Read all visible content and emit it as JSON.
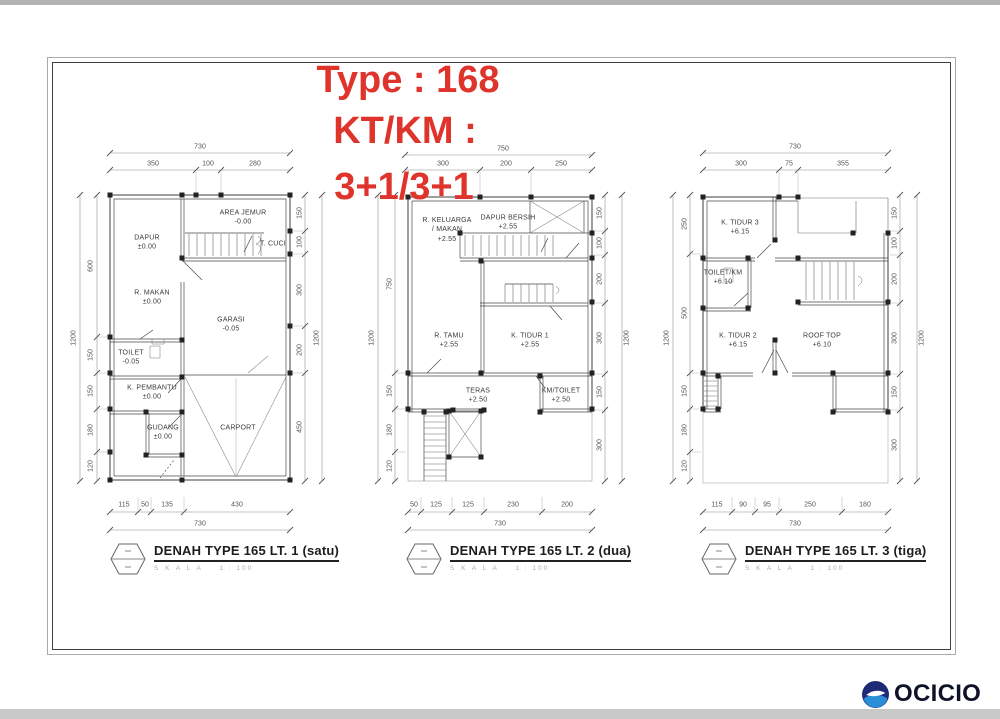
{
  "page": {
    "title_lines": [
      "Type : 168",
      "KT/KM :",
      "3+1/3+1"
    ],
    "accent_red": "#de342b",
    "logo_text": "OCICIO",
    "logo_navy": "#1d2b77",
    "logo_blue": "#2b8fd8"
  },
  "plans": [
    {
      "caption": "DENAH TYPE 165 LT. 1 (satu)",
      "scale_label": "S K A L A",
      "scale_value": "1 : 100",
      "rooms": [
        {
          "text": "AREA JEMUR\n-0.00",
          "x": 243,
          "y": 218
        },
        {
          "text": "DAPUR\n±0.00",
          "x": 147,
          "y": 243
        },
        {
          "text": "T. CUCI",
          "x": 273,
          "y": 244
        },
        {
          "text": "R. MAKAN\n±0.00",
          "x": 152,
          "y": 298
        },
        {
          "text": "GARASI\n-0.05",
          "x": 231,
          "y": 325
        },
        {
          "text": "TOILET\n-0.05",
          "x": 131,
          "y": 358
        },
        {
          "text": "K. PEMBANTU\n±0.00",
          "x": 152,
          "y": 393
        },
        {
          "text": "GUDANG\n±0.00",
          "x": 163,
          "y": 433
        },
        {
          "text": "CARPORT",
          "x": 238,
          "y": 428
        }
      ],
      "dims": [
        {
          "text": "730",
          "x": 200,
          "y": 147
        },
        {
          "text": "350",
          "x": 153,
          "y": 164
        },
        {
          "text": "100",
          "x": 208,
          "y": 164
        },
        {
          "text": "280",
          "x": 255,
          "y": 164
        },
        {
          "text": "1200",
          "x": 74,
          "y": 338,
          "rot": true
        },
        {
          "text": "600",
          "x": 91,
          "y": 266,
          "rot": true
        },
        {
          "text": "150",
          "x": 91,
          "y": 355,
          "rot": true
        },
        {
          "text": "150",
          "x": 91,
          "y": 391,
          "rot": true
        },
        {
          "text": "180",
          "x": 91,
          "y": 430,
          "rot": true
        },
        {
          "text": "120",
          "x": 91,
          "y": 466,
          "rot": true
        },
        {
          "text": "150",
          "x": 300,
          "y": 213,
          "rot": true
        },
        {
          "text": "100",
          "x": 300,
          "y": 242,
          "rot": true
        },
        {
          "text": "300",
          "x": 300,
          "y": 290,
          "rot": true
        },
        {
          "text": "200",
          "x": 300,
          "y": 350,
          "rot": true
        },
        {
          "text": "450",
          "x": 300,
          "y": 427,
          "rot": true
        },
        {
          "text": "1200",
          "x": 317,
          "y": 338,
          "rot": true
        },
        {
          "text": "115",
          "x": 124,
          "y": 505
        },
        {
          "text": "50",
          "x": 145,
          "y": 505
        },
        {
          "text": "135",
          "x": 167,
          "y": 505
        },
        {
          "text": "430",
          "x": 237,
          "y": 505
        },
        {
          "text": "730",
          "x": 200,
          "y": 524
        }
      ]
    },
    {
      "caption": "DENAH TYPE 165 LT. 2 (dua)",
      "scale_label": "S K A L A",
      "scale_value": "1 : 100",
      "rooms": [
        {
          "text": "R. KELUARGA\n/  MAKAN\n+2.55",
          "x": 447,
          "y": 230
        },
        {
          "text": "DAPUR BERSIH\n+2.55",
          "x": 508,
          "y": 223
        },
        {
          "text": "R. TAMU\n+2.55",
          "x": 449,
          "y": 341
        },
        {
          "text": "K. TIDUR 1\n+2.55",
          "x": 530,
          "y": 341
        },
        {
          "text": "TERAS\n+2.50",
          "x": 478,
          "y": 396
        },
        {
          "text": "KM/TOILET\n+2.50",
          "x": 561,
          "y": 396
        }
      ],
      "dims": [
        {
          "text": "750",
          "x": 503,
          "y": 149
        },
        {
          "text": "300",
          "x": 443,
          "y": 164
        },
        {
          "text": "200",
          "x": 506,
          "y": 164
        },
        {
          "text": "250",
          "x": 561,
          "y": 164
        },
        {
          "text": "1200",
          "x": 372,
          "y": 338,
          "rot": true
        },
        {
          "text": "750",
          "x": 390,
          "y": 284,
          "rot": true
        },
        {
          "text": "150",
          "x": 390,
          "y": 391,
          "rot": true
        },
        {
          "text": "180",
          "x": 390,
          "y": 430,
          "rot": true
        },
        {
          "text": "120",
          "x": 390,
          "y": 466,
          "rot": true
        },
        {
          "text": "150",
          "x": 600,
          "y": 213,
          "rot": true
        },
        {
          "text": "100",
          "x": 600,
          "y": 243,
          "rot": true
        },
        {
          "text": "200",
          "x": 600,
          "y": 279,
          "rot": true
        },
        {
          "text": "300",
          "x": 600,
          "y": 338,
          "rot": true
        },
        {
          "text": "150",
          "x": 600,
          "y": 392,
          "rot": true
        },
        {
          "text": "300",
          "x": 600,
          "y": 445,
          "rot": true
        },
        {
          "text": "1200",
          "x": 627,
          "y": 338,
          "rot": true
        },
        {
          "text": "50",
          "x": 414,
          "y": 505
        },
        {
          "text": "125",
          "x": 436,
          "y": 505
        },
        {
          "text": "125",
          "x": 468,
          "y": 505
        },
        {
          "text": "230",
          "x": 513,
          "y": 505
        },
        {
          "text": "200",
          "x": 567,
          "y": 505
        },
        {
          "text": "730",
          "x": 500,
          "y": 524
        }
      ]
    },
    {
      "caption": "DENAH TYPE 165 LT. 3 (tiga)",
      "scale_label": "S K A L A",
      "scale_value": "1 : 100",
      "rooms": [
        {
          "text": "K. TIDUR 3\n+6.15",
          "x": 740,
          "y": 228
        },
        {
          "text": "TOILET/KM\n+6.10",
          "x": 723,
          "y": 278
        },
        {
          "text": "K. TIDUR 2\n+6.15",
          "x": 738,
          "y": 341
        },
        {
          "text": "ROOF TOP\n+6.10",
          "x": 822,
          "y": 341
        }
      ],
      "dims": [
        {
          "text": "730",
          "x": 795,
          "y": 147
        },
        {
          "text": "300",
          "x": 741,
          "y": 164
        },
        {
          "text": "75",
          "x": 789,
          "y": 164
        },
        {
          "text": "355",
          "x": 843,
          "y": 164
        },
        {
          "text": "1200",
          "x": 667,
          "y": 338,
          "rot": true
        },
        {
          "text": "250",
          "x": 685,
          "y": 224,
          "rot": true
        },
        {
          "text": "500",
          "x": 685,
          "y": 313,
          "rot": true
        },
        {
          "text": "150",
          "x": 685,
          "y": 391,
          "rot": true
        },
        {
          "text": "180",
          "x": 685,
          "y": 430,
          "rot": true
        },
        {
          "text": "120",
          "x": 685,
          "y": 466,
          "rot": true
        },
        {
          "text": "150",
          "x": 895,
          "y": 213,
          "rot": true
        },
        {
          "text": "100",
          "x": 895,
          "y": 243,
          "rot": true
        },
        {
          "text": "200",
          "x": 895,
          "y": 279,
          "rot": true
        },
        {
          "text": "300",
          "x": 895,
          "y": 338,
          "rot": true
        },
        {
          "text": "150",
          "x": 895,
          "y": 392,
          "rot": true
        },
        {
          "text": "300",
          "x": 895,
          "y": 445,
          "rot": true
        },
        {
          "text": "1200",
          "x": 922,
          "y": 338,
          "rot": true
        },
        {
          "text": "115",
          "x": 717,
          "y": 505
        },
        {
          "text": "90",
          "x": 743,
          "y": 505
        },
        {
          "text": "95",
          "x": 767,
          "y": 505
        },
        {
          "text": "250",
          "x": 810,
          "y": 505
        },
        {
          "text": "180",
          "x": 865,
          "y": 505
        },
        {
          "text": "730",
          "x": 795,
          "y": 524
        }
      ]
    }
  ]
}
